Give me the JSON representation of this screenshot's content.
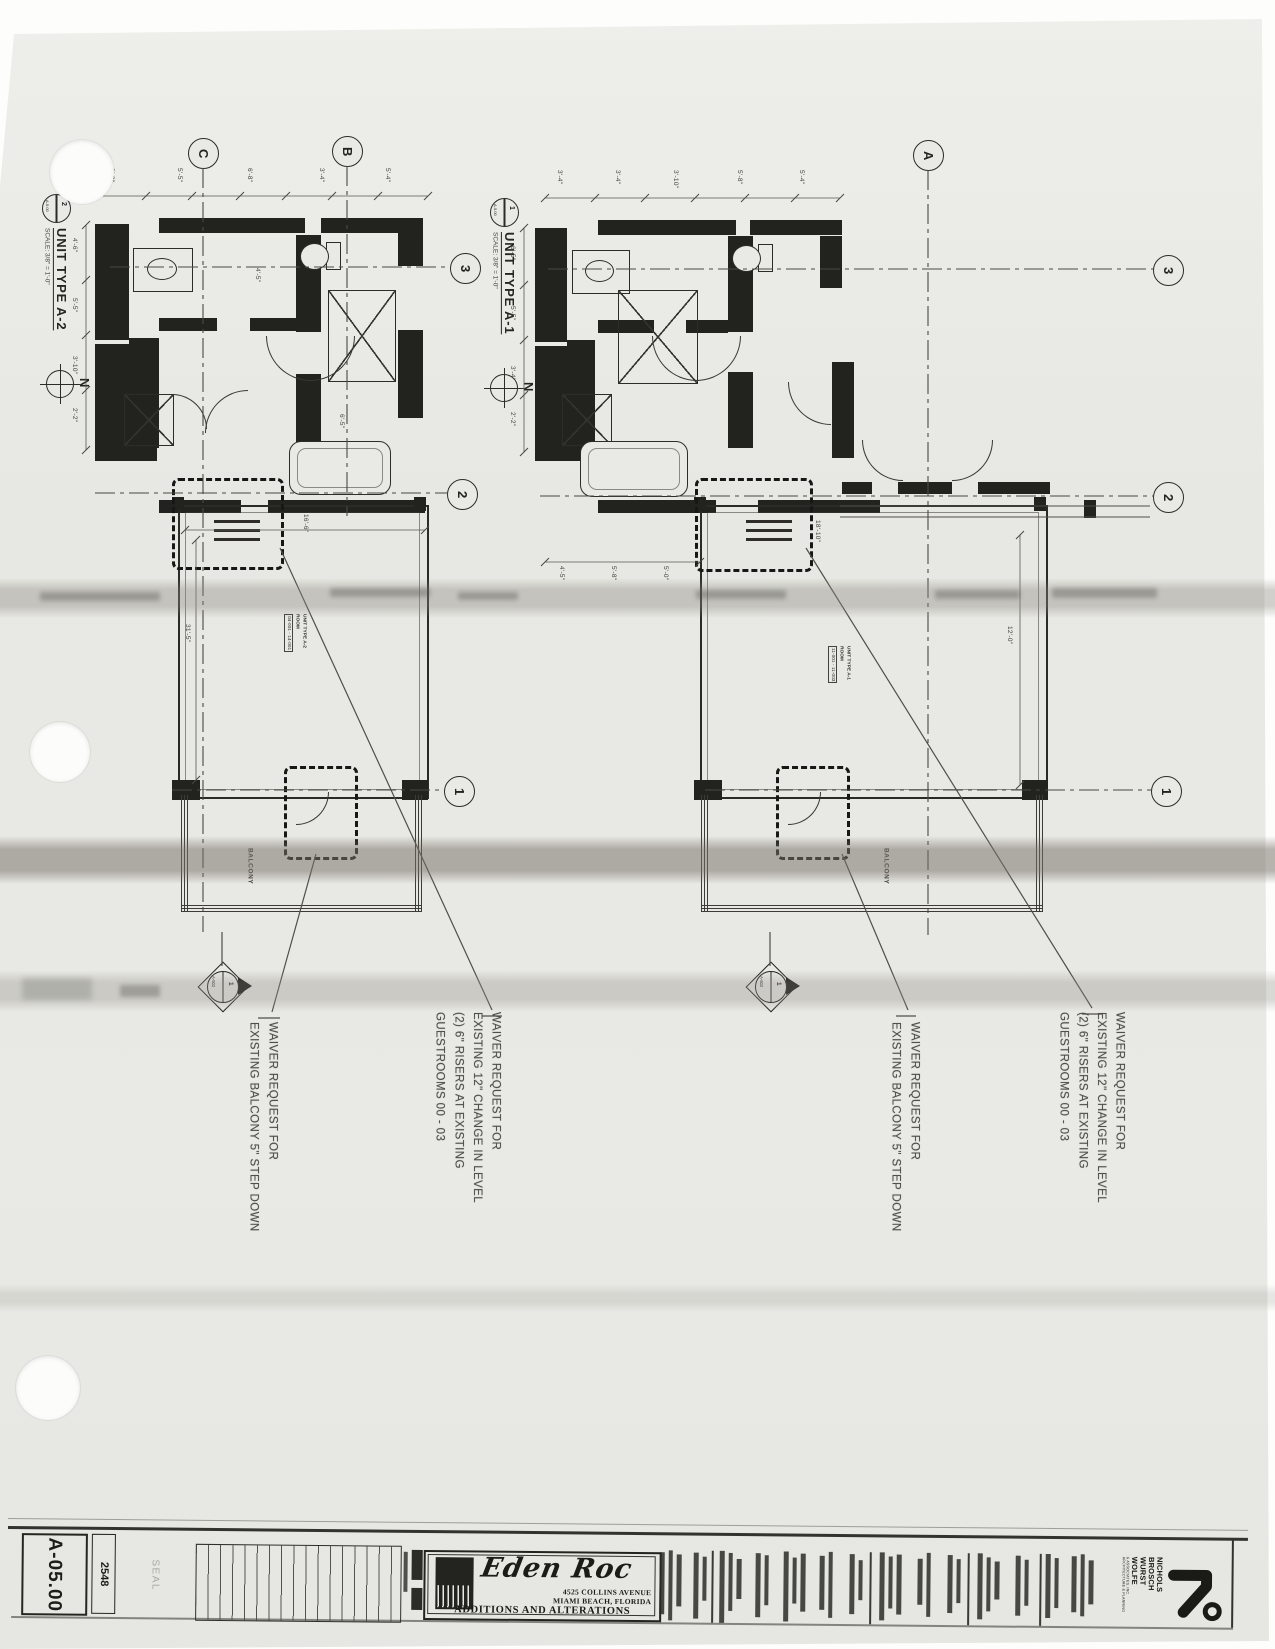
{
  "plans": {
    "scale_label": "SCALE: 3/8\" = 1'-0\"",
    "north_label": "N",
    "balcony_label": "BALCONY",
    "section_marker": {
      "number": "1",
      "sheet": "A-502"
    },
    "left": {
      "title": "UNIT TYPE A-2",
      "tag_number": "2",
      "tag_sheet": "A-5.00",
      "room": [
        "UNIT TYPE A-2",
        "ROOM",
        "04-001 - 14-001"
      ]
    },
    "right": {
      "title": "UNIT TYPE A-1",
      "tag_number": "1",
      "tag_sheet": "A-5.00",
      "room": [
        "UNIT TYPE A-1",
        "ROOM",
        "11-001 - 11-003"
      ]
    }
  },
  "grids": {
    "c": "C",
    "b": "B",
    "a": "A",
    "n3": "3",
    "n2": "2",
    "n1": "1"
  },
  "dims": [
    "5'-5\"",
    "3'-4\"",
    "6'-8\"",
    "8'-2\"",
    "4'-6\"",
    "6'-5\"",
    "3'-10\"",
    "5'-8\"",
    "2'-2\"",
    "5'-0\"",
    "16'-6\"",
    "31'-5\"",
    "18'-10\"",
    "12'-0\"",
    "4'-5\"",
    "5'-4\""
  ],
  "annotations": {
    "balcony_note": [
      "WAIVER REQUEST FOR",
      "EXISTING BALCONY 5\" STEP DOWN"
    ],
    "riser_note": [
      "WAIVER REQUEST FOR",
      "EXISTING 12\" CHANGE IN LEVEL",
      "(2) 6\" RISERS AT EXISTING",
      "GUESTROOMS 00 - 03"
    ]
  },
  "titleblock": {
    "sheet_number": "A-05.00",
    "project_number": "2548",
    "seal_label": "SEAL",
    "logo_name": "Eden Roc",
    "address_line1": "4525 COLLINS AVENUE",
    "address_line2": "MIAMI BEACH, FLORIDA",
    "subtitle": "ADDITIONS AND ALTERATIONS",
    "firm_lines": [
      "NICHOLS",
      "BROSCH",
      "WURST",
      "WOLFE"
    ],
    "firm_sub1": "& ASSOCIATES, INC.",
    "firm_sub2": "ARCHITECTURE & PLANNING"
  }
}
